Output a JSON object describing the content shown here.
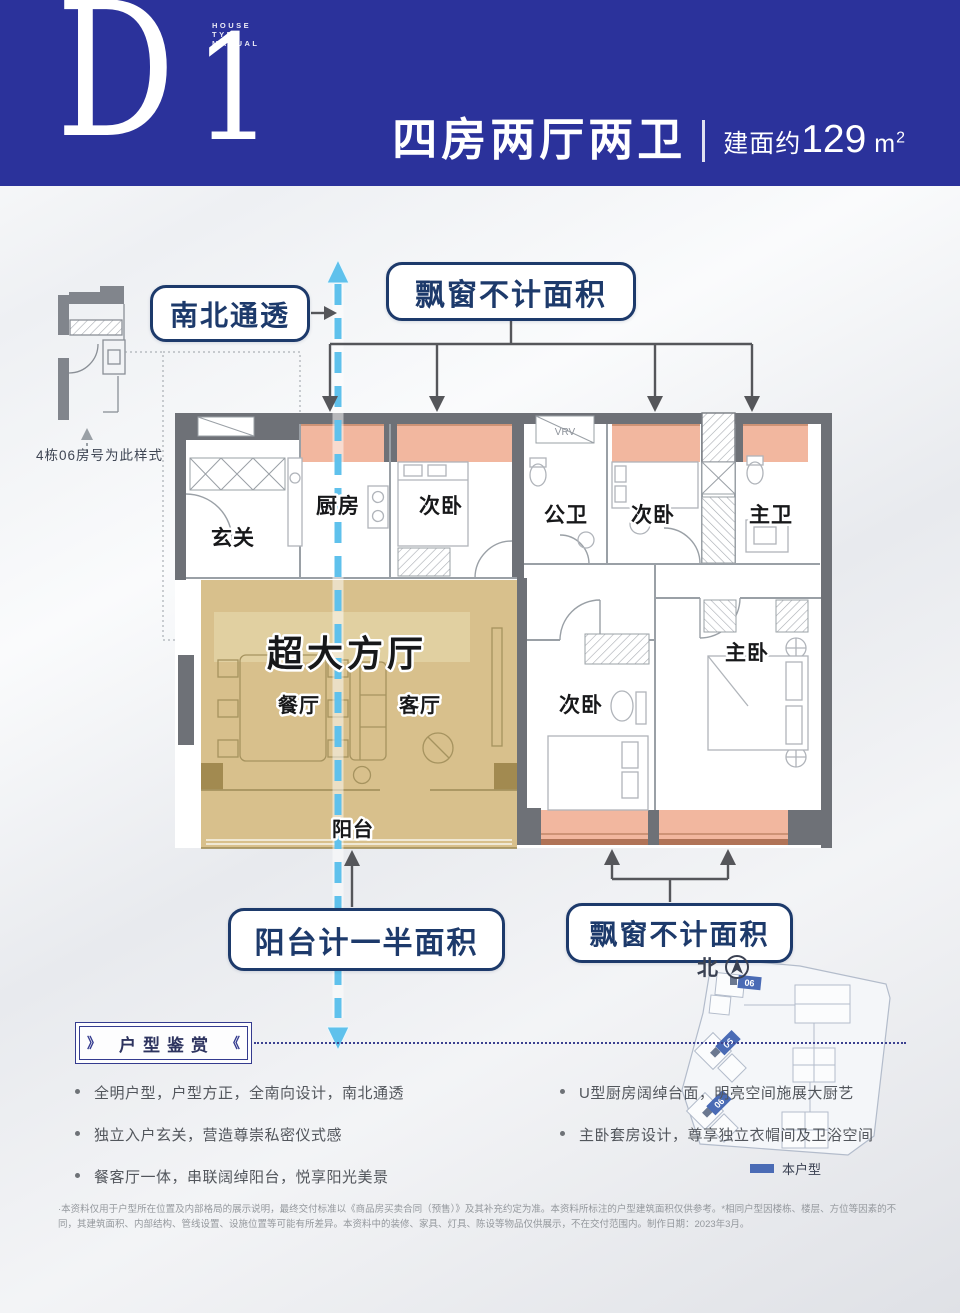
{
  "colors": {
    "header_blue": "#2b329b",
    "callout_navy": "#1d3a6b",
    "bay_window_salmon": "#f1b197",
    "grand_hall_tan": "#d6bd86",
    "axis_blue": "#5fc1ec",
    "site_tag_blue": "#4a6bb5"
  },
  "header": {
    "logo_letter": "D",
    "logo_number": "1",
    "logo_caption_lines": [
      "HOUSE",
      "TYPE",
      "MANUAL"
    ],
    "title": "四房两厅两卫",
    "area_prefix": "建面约",
    "area_value": "129",
    "area_unit": "m",
    "area_sup": "2"
  },
  "callouts": {
    "north_south": "南北通透",
    "bay_window_top": "飘窗不计面积",
    "balcony_half": "阳台计一半面积",
    "bay_window_bottom": "飘窗不计面积"
  },
  "plan": {
    "sample_note": "4栋06房号为此样式",
    "vrv_label": "VRV",
    "rooms": {
      "entry": "玄关",
      "kitchen": "厨房",
      "bedroom_top_left": "次卧",
      "public_bath": "公卫",
      "bedroom_top_right": "次卧",
      "master_bath": "主卫",
      "grand_hall": "超大方厅",
      "dining": "餐厅",
      "living": "客厅",
      "balcony": "阳台",
      "bedroom_bottom": "次卧",
      "master_bedroom": "主卧"
    }
  },
  "compass": {
    "north_label": "北"
  },
  "siteplan": {
    "unit_tags": [
      "06",
      "06",
      "06"
    ],
    "legend_label": "本户型"
  },
  "appreciation": {
    "title": "户型鉴赏",
    "bullets_left": [
      "全明户型，户型方正，全南向设计，南北通透",
      "独立入户玄关，营造尊崇私密仪式感",
      "餐客厅一体，串联阔绰阳台，悦享阳光美景"
    ],
    "bullets_right": [
      "U型厨房阔绰台面，明亮空间施展大厨艺",
      "主卧套房设计，尊享独立衣帽间及卫浴空间"
    ]
  },
  "disclaimer": "·本资料仅用于户型所在位置及内部格局的展示说明，最终交付标准以《商品房买卖合同（预售）》及其补充约定为准。本资料所标注的户型建筑面积仅供参考。*相同户型因楼栋、楼层、方位等因素的不同，其建筑面积、内部结构、管线设置、设施位置等可能有所差异。本资料中的装修、家具、灯具、陈设等物品仅供展示，不在交付范围内。制作日期：2023年3月。"
}
